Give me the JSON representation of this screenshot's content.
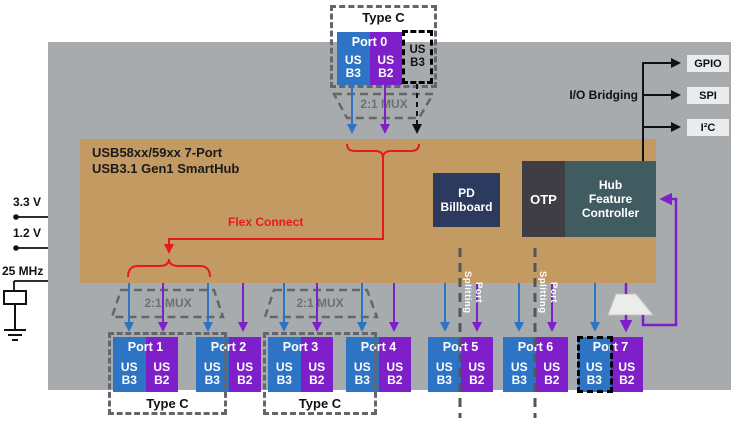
{
  "colors": {
    "gray_bg": "#a7abae",
    "tan": "#c49a63",
    "blue": "#2e74c4",
    "purple": "#7e1fc9",
    "navy": "#2b3a5e",
    "otp_dark": "#3f3e44",
    "teal": "#415c60",
    "red": "#e8191d"
  },
  "hub": {
    "title_line1": "USB58xx/59xx 7-Port",
    "title_line2": "USB3.1 Gen1 SmartHub"
  },
  "labels": {
    "type_c": "Type C",
    "mux": "2:1 MUX",
    "port_splitting": "Port Splitting",
    "flex_connect": "Flex Connect",
    "io_bridging": "I/O Bridging"
  },
  "power": {
    "rail_33": "3.3 V",
    "rail_12": "1.2 V",
    "clock": "25 MHz"
  },
  "io_bridging_targets": [
    {
      "label": "GPIO"
    },
    {
      "label": "SPI"
    },
    {
      "label": "I²C"
    }
  ],
  "blocks": {
    "pd_billboard": {
      "line1": "PD",
      "line2": "Billboard"
    },
    "otp": {
      "label": "OTP"
    },
    "hub_feature_controller": {
      "line1": "Hub",
      "line2": "Feature",
      "line3": "Controller"
    }
  },
  "port0": {
    "label": "Port 0",
    "b3_line1": "US",
    "b3_line2": "B3",
    "b2_line1": "US",
    "b2_line2": "B2",
    "alt_b3_line1": "US",
    "alt_b3_line2": "B3"
  },
  "ports": [
    {
      "label": "Port 1",
      "b3_line1": "US",
      "b3_line2": "B3",
      "b2_line1": "US",
      "b2_line2": "B2"
    },
    {
      "label": "Port 2",
      "b3_line1": "US",
      "b3_line2": "B3",
      "b2_line1": "US",
      "b2_line2": "B2"
    },
    {
      "label": "Port 3",
      "b3_line1": "US",
      "b3_line2": "B3",
      "b2_line1": "US",
      "b2_line2": "B2"
    },
    {
      "label": "Port 4",
      "b3_line1": "US",
      "b3_line2": "B3",
      "b2_line1": "US",
      "b2_line2": "B2"
    },
    {
      "label": "Port 5",
      "b3_line1": "US",
      "b3_line2": "B3",
      "b2_line1": "US",
      "b2_line2": "B2"
    },
    {
      "label": "Port 6",
      "b3_line1": "US",
      "b3_line2": "B3",
      "b2_line1": "US",
      "b2_line2": "B2"
    },
    {
      "label": "Port 7",
      "b3_line1": "US",
      "b3_line2": "B3",
      "b2_line1": "US",
      "b2_line2": "B2"
    }
  ]
}
